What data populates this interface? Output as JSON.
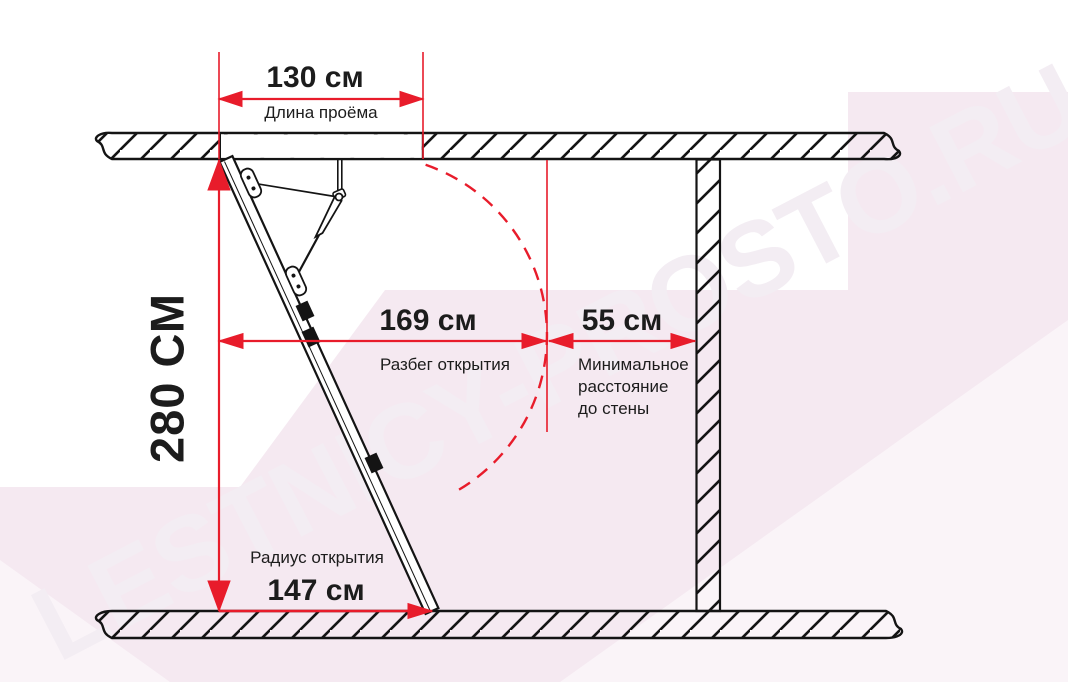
{
  "watermark": {
    "text": "LESTNICY-PROSTO.RU"
  },
  "colors": {
    "dimension_red": "#e81c2b",
    "line_black": "#141414",
    "background_pink": "#f5e9f1"
  },
  "dimensions": {
    "opening_length": {
      "value": "130 см",
      "label": "Длина проёма"
    },
    "room_height": {
      "value": "280 СМ"
    },
    "opening_run": {
      "value": "169 см",
      "label": "Разбег открытия"
    },
    "min_wall_distance": {
      "value": "55 см",
      "label_lines": [
        "Минимальное",
        "расстояние",
        "до стены"
      ]
    },
    "opening_radius": {
      "value": "147 см",
      "label": "Радиус открытия"
    }
  }
}
